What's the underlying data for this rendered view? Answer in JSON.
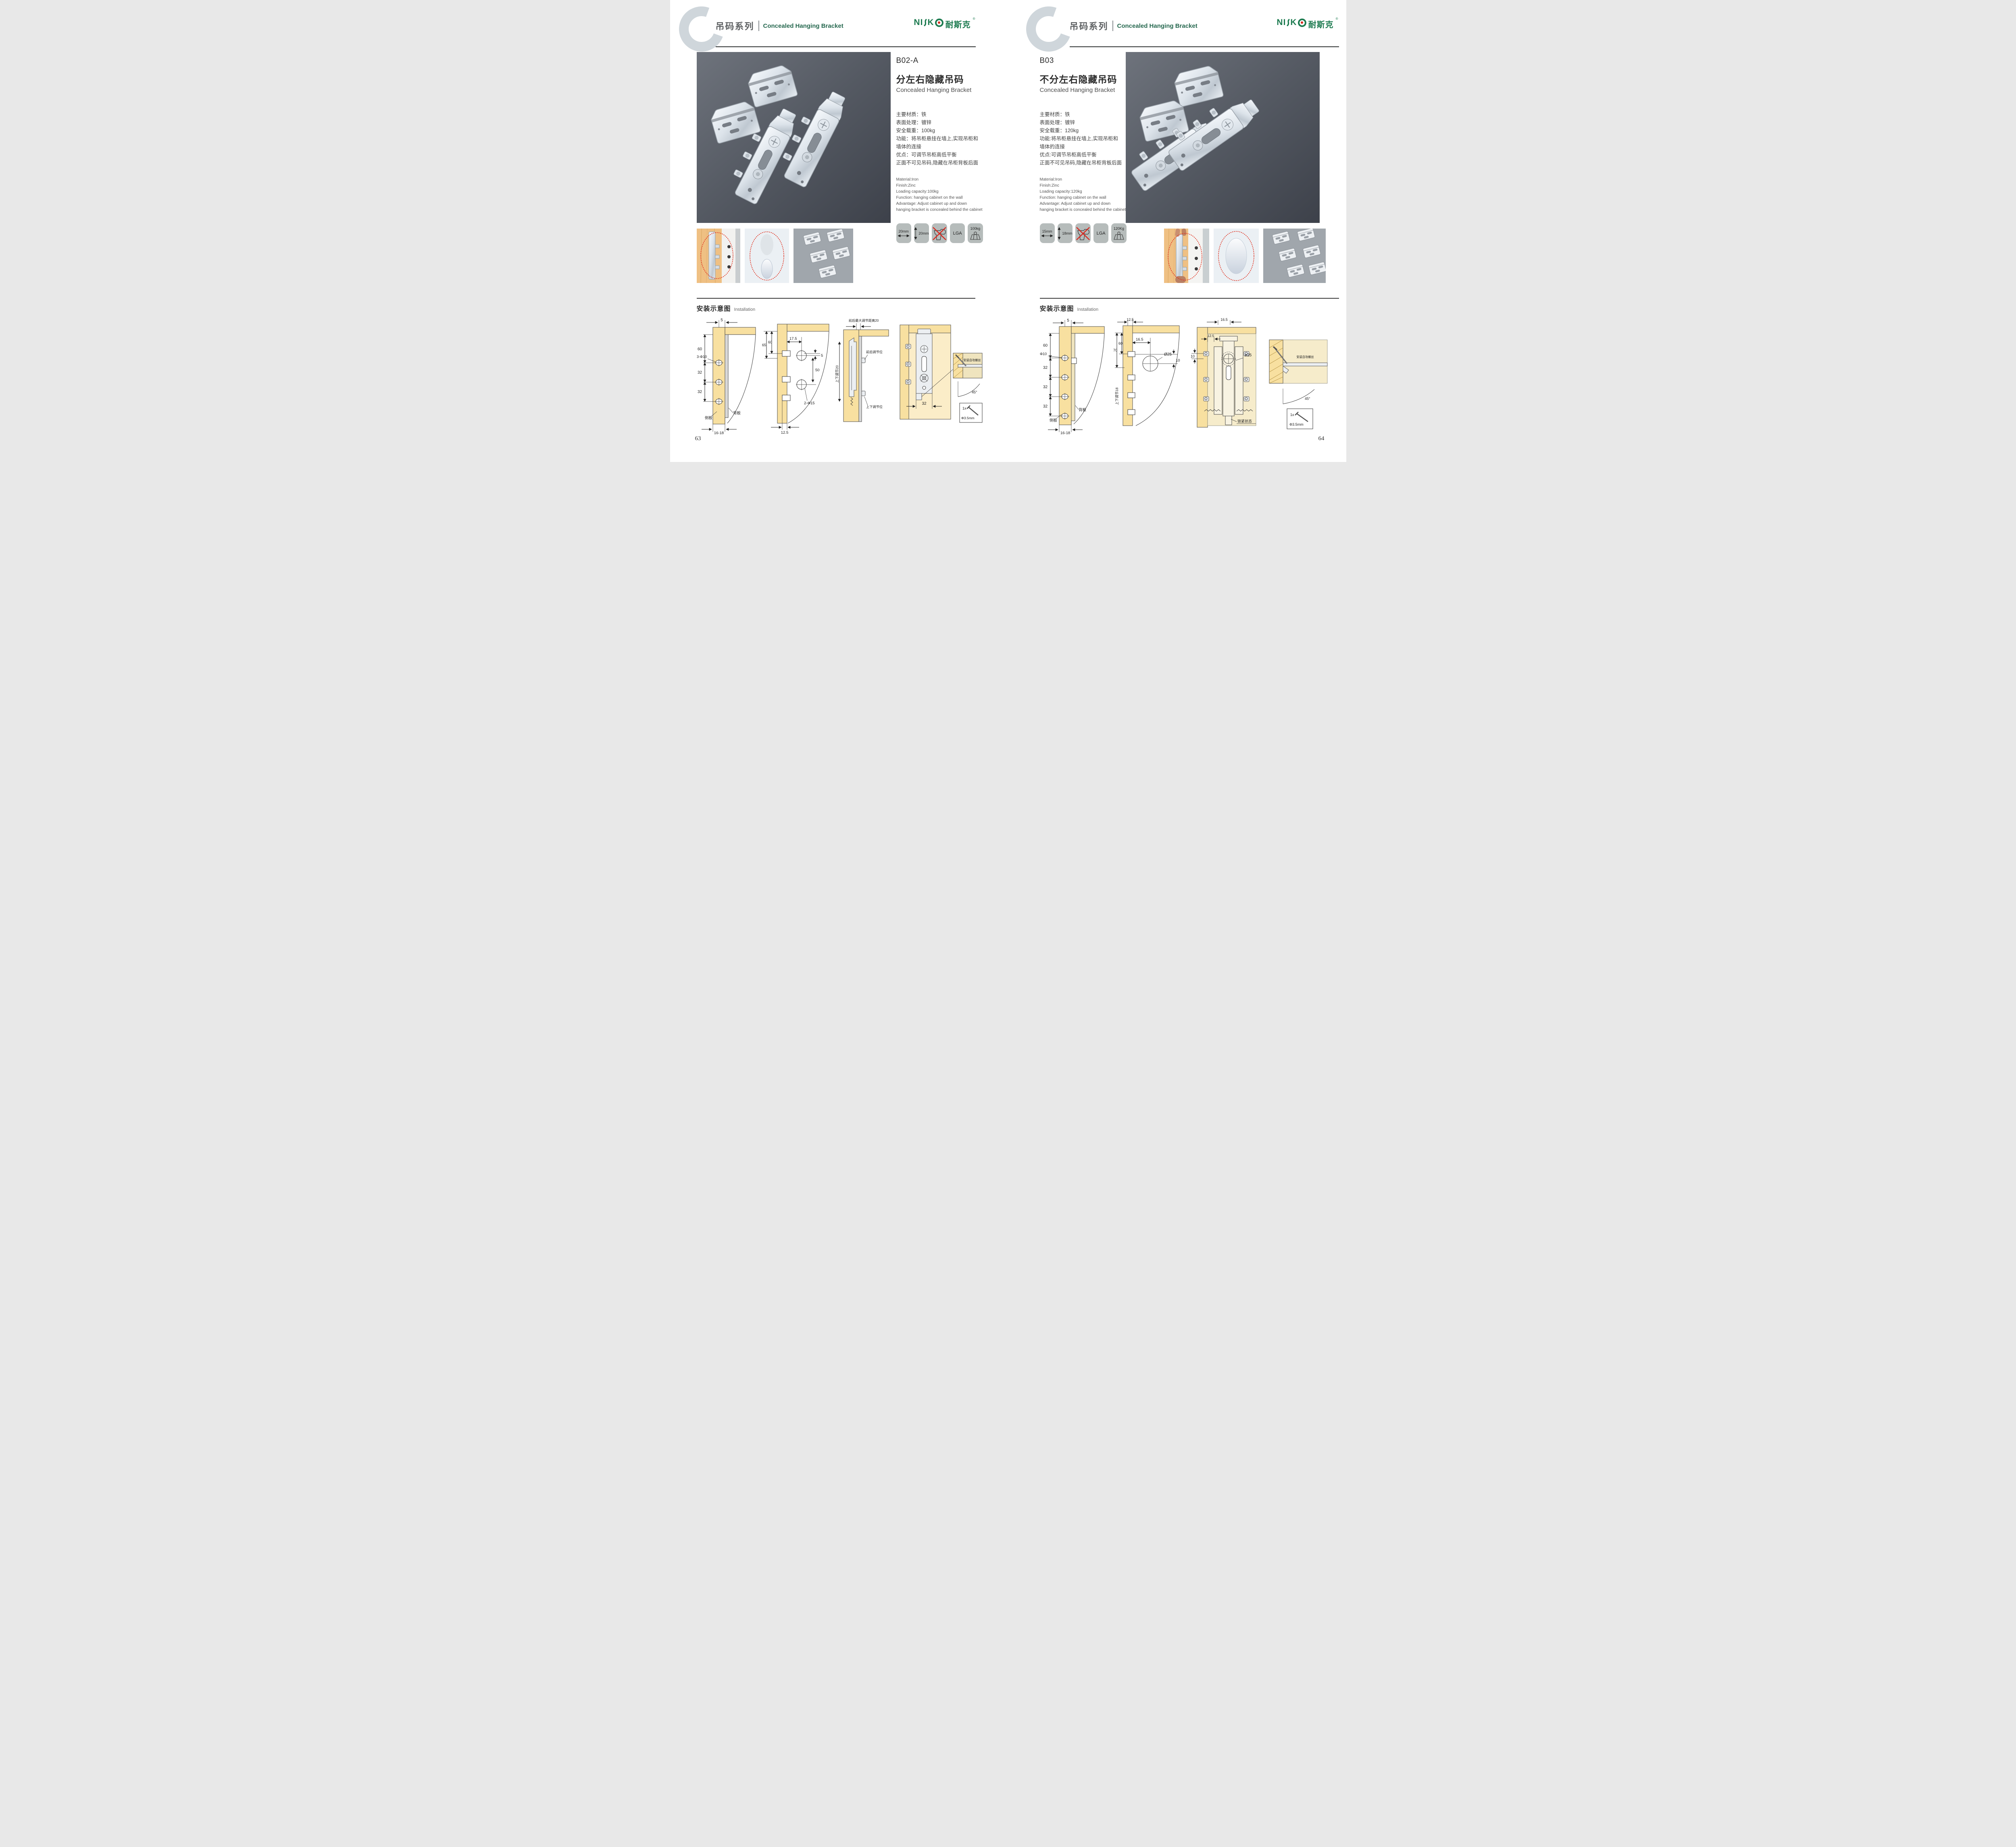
{
  "colors": {
    "brand_green": "#1D7B50",
    "accent_red": "#D8281E",
    "wood": "#F8E0A0",
    "photo_bg": "#565B64",
    "badge_bg": "#B6BCBB",
    "ring_gray": "#CFD6DB"
  },
  "logo": {
    "full": "NISKO",
    "left": "NI",
    "k": "K",
    "cn": "耐斯克",
    "reg": "®"
  },
  "header": {
    "series_cn": "吊码系列",
    "series_en": "Concealed Hanging Bracket"
  },
  "install_heading": {
    "cn": "安装示意图",
    "en": "Installation"
  },
  "pages": {
    "left": {
      "page_number": "63",
      "product": {
        "code": "B02-A",
        "title_cn": "分左右隐藏吊码",
        "title_en": "Concealed Hanging Bracket",
        "specs_cn": [
          "主要材质：铁",
          "表面处理：镀锌",
          "安全载重：100kg",
          "功能：将吊柜悬挂在墙上,实现吊柜和",
          "墙体的连接",
          "优点：可调节吊柜高低平衡",
          "正面不可见吊码,隐藏在吊柜背板后面"
        ],
        "specs_en": [
          "Material:Iron",
          "Finish:Zinc",
          "Loading capacity:100kg",
          "Function: hanging cabinet on the wall",
          "Advantage: Adjust cabinet up and down",
          "hanging bracket is concealed behind the cabinet"
        ],
        "badges": {
          "width": "20mm",
          "height": "20mm",
          "cert": "LGA",
          "load": "100kg"
        }
      },
      "install": {
        "d1": {
          "top": "5",
          "v1": "60",
          "hole_label": "3-Φ10",
          "v2": "32",
          "v3": "32",
          "side": "侧板",
          "back": "背板",
          "bottom": "16-18"
        },
        "d2": {
          "a": "65",
          "b": "60",
          "c": "17.5",
          "d": "5",
          "e": "50",
          "hole_label": "2-Φ15",
          "bottom": "12.5"
        },
        "d3": {
          "top": "前后最大调节距离20",
          "left": "上下调节20",
          "ann1": "前后调节位",
          "ann2": "上下调节位"
        },
        "d4": {
          "dim": "32",
          "screw": "安装自攻螺丝",
          "angle": "45°",
          "qty": "1x",
          "dia": "Φ3.5mm"
        }
      }
    },
    "right": {
      "page_number": "64",
      "product": {
        "code": "B03",
        "title_cn": "不分左右隐藏吊码",
        "title_en": "Concealed Hanging Bracket",
        "specs_cn": [
          "主要材质：铁",
          "表面处理：镀锌",
          "安全载重：120kg",
          "功能:将吊柜悬挂在墙上,实现吊柜和",
          "墙体的连接",
          "优点:可调节吊柜高低平衡",
          "正面不可见吊码,隐藏在吊柜背板后面"
        ],
        "specs_en": [
          "Material:Iron",
          "Finish:Zinc",
          "Loading capacity:120kg",
          "Function: hanging cabinet on the wall",
          "Advantage: Adjust cabinet up and down",
          "hanging bracket is concealed behind the cabinet"
        ],
        "badges": {
          "width": "15mm",
          "height": "18mm",
          "cert": "LGA",
          "load": "120Kg"
        }
      },
      "install": {
        "d1": {
          "top": "5",
          "v1": "60",
          "hole_label": "Φ10",
          "v2": "32",
          "v3": "32",
          "v4": "32",
          "back": "背板",
          "side": "侧板",
          "bottom": "16-18"
        },
        "d2": {
          "top": "12.5",
          "a": "70",
          "b": "60",
          "c": "16.5",
          "dia": "Ø25",
          "e": "10",
          "left": "上下调节18"
        },
        "d3": {
          "top": "16.5",
          "a": "12.5",
          "b": "10",
          "dia": "ø25",
          "state": "锁紧状态"
        },
        "d4": {
          "screw": "安装自攻螺丝",
          "angle": "45°",
          "qty": "1x",
          "dia": "Φ3.5mm"
        }
      }
    }
  }
}
